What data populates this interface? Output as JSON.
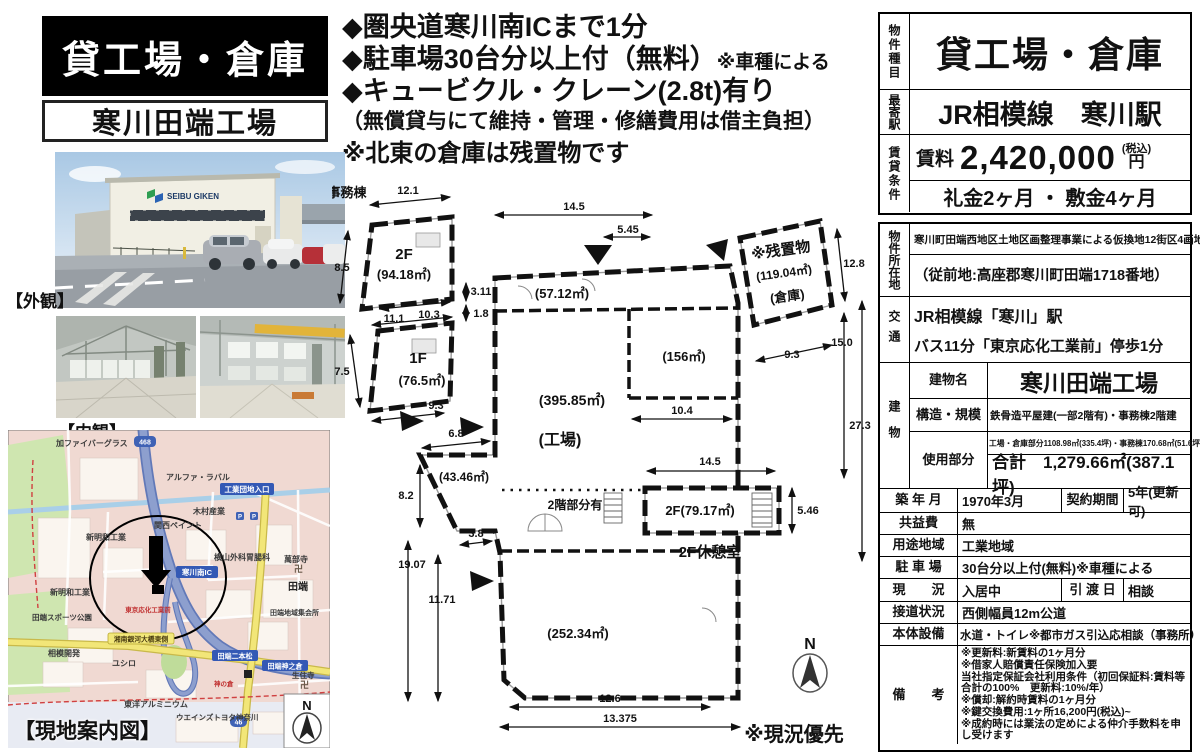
{
  "header": {
    "property_type": "貸工場・倉庫",
    "property_name": "寒川田端工場"
  },
  "highlights": {
    "line1": "◆圏央道寒川南ICまで1分",
    "line2_main": "◆駐車場30台分以上付（無料）",
    "line2_note": "※車種による",
    "line3": "◆キュービクル・クレーン(2.8t)有り",
    "line4": "（無償貸与にて維持・管理・修繕費用は借主負担）",
    "line5": "※北東の倉庫は残置物です"
  },
  "photos": {
    "exterior_caption": "【外観】",
    "interior_caption": "【内観】",
    "building_logo": "SEIBU GIKEN"
  },
  "floorplan": {
    "office_label": "事務棟",
    "rooms": {
      "office_2f": "2F",
      "office_2f_area": "(94.18㎡)",
      "office_1f": "1F",
      "office_1f_area": "(76.5㎡)",
      "room_5712": "(57.12㎡)",
      "room_156": "(156㎡)",
      "room_39585": "(395.85㎡)",
      "factory": "(工場)",
      "room_4346": "(43.46㎡)",
      "room_25234": "(252.34㎡)",
      "mezzanine_note": "2階部分有",
      "room_2f": "2F(79.17㎡)",
      "rest_room": "2F休憩室",
      "warehouse_note": "※残置物",
      "warehouse_area": "(119.04㎡)",
      "warehouse": "(倉庫)"
    },
    "dims": {
      "d121": "12.1",
      "d85": "8.5",
      "d311": "3.11",
      "d18": "1.8",
      "d103": "10.3",
      "d111": "11.1",
      "d75": "7.5",
      "d93a": "9.3",
      "d145a": "14.5",
      "d545": "5.45",
      "d128": "12.8",
      "d93b": "9.3",
      "d150": "15.0",
      "d273": "27.3",
      "d104": "10.4",
      "d145b": "14.5",
      "d546": "5.46",
      "d68": "6.8",
      "d82": "8.2",
      "d38": "3.8",
      "d1907": "19.07",
      "d1171": "11.71",
      "d126": "12.6",
      "d13375": "13.375"
    },
    "note": "※現況優先",
    "compass": "N"
  },
  "map": {
    "caption": "【現地案内図】",
    "compass": "N",
    "route_badge": "468",
    "road_badge": "46",
    "labels": {
      "l1": "加ファイバーグラス",
      "l2": "アルファ・ラバル",
      "l3": "木村産業",
      "l4": "関西ペイント",
      "l5": "新明和工業",
      "l6": "横山外科胃腸科",
      "l7": "萬部寺",
      "l8": "田端",
      "l9": "新明和工業",
      "l10": "田端地域集会所",
      "l11": "田端スポーツ公園",
      "l12": "相模開発",
      "l13": "ユシロ",
      "l14": "神の倉",
      "l15": "生住寺",
      "l16": "東洋アルミニウム",
      "l17": "ウエインズトヨタ神奈川",
      "temple_mark": "卍"
    },
    "road_labels": {
      "ic": "寒川南IC",
      "entrance": "工業団地入口",
      "nihonmatsu": "田端二本松",
      "kaminokura": "田端神之倉",
      "bridge": "湘南銀河大橋東側",
      "bus_stop": "東京応化工業前"
    }
  },
  "spec": {
    "type_label": "物件種目",
    "type_value": "貸工場・倉庫",
    "station_label": "最寄駅",
    "station_value": "JR相模線　寒川駅",
    "terms_label": "賃貸条件",
    "rent_label": "賃料",
    "rent_value": "2,420,000",
    "rent_tax": "(税込)",
    "rent_unit": "円",
    "deposit_value": "礼金2ヶ月 ・ 敷金4ヶ月",
    "location_label": "物件所在地",
    "location_line1": "寒川町田端西地区土地区画整理事業による仮換地12街区4画地",
    "location_line2": "（従前地:高座郡寒川町田端1718番地）",
    "access_label": "交通",
    "access_line1": "JR相模線「寒川」駅",
    "access_line2": "バス11分「東京応化工業前」停歩1分",
    "building_label": "建物",
    "building_name_label": "建物名",
    "building_name": "寒川田端工場",
    "structure_label": "構造・規模",
    "structure_value": "鉄骨造平屋建(一部2階有)・事務棟2階建",
    "use_label": "使用部分",
    "use_line1": "工場・倉庫部分1108.98㎡(335.4坪)・事務棟170.68㎡(51.6坪)",
    "use_total": "合計　1,279.66㎡(387.1坪)",
    "built_label": "築 年 月",
    "built_value": "1970年3月",
    "contract_label": "契約期間",
    "contract_value": "5年(更新可)",
    "fee_label": "共益費",
    "fee_value": "無",
    "zone_label": "用途地域",
    "zone_value": "工業地域",
    "parking_label": "駐 車 場",
    "parking_value": "30台分以上付(無料)※車種による",
    "status_label": "現　　況",
    "status_value": "入居中",
    "handover_label": "引 渡 日",
    "handover_value": "相談",
    "road_label": "接道状況",
    "road_value": "西側幅員12m公道",
    "equip_label": "本体設備",
    "equip_value": "水道・トイレ※都市ガス引込応相談（事務所）",
    "remarks_label": "備　　考",
    "remarks": {
      "r1": "※更新料:新賃料の1ヶ月分",
      "r2": "※借家人賠償責任保険加入要",
      "r3": "当社指定保証会社利用条件（初回保証料:賃料等合計の100%　更新料:10%/年）",
      "r4": "※償却:解約時賃料の1ヶ月分",
      "r5": "※鍵交換費用:1ヶ所16,200円(税込)~",
      "r6": "※成約時には業法の定めによる仲介手数料を申し受けます"
    }
  }
}
